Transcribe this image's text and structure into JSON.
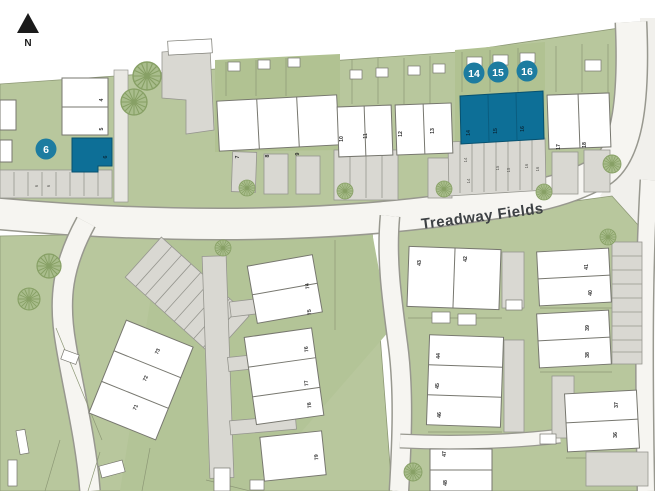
{
  "map": {
    "north_label": "N",
    "street_label": "Treadway Fields",
    "highlighted_plot_badges": [
      "6",
      "14",
      "15",
      "16"
    ],
    "plot_numbers": {
      "top_row": [
        "4",
        "5",
        "6",
        "7",
        "8",
        "9",
        "10",
        "11",
        "12",
        "13",
        "14",
        "15",
        "16",
        "17",
        "18"
      ],
      "terrace_71_73": [
        "71",
        "72",
        "73"
      ],
      "terrace_74_79": [
        "74",
        "75",
        "76",
        "77",
        "78",
        "79"
      ],
      "central_block": [
        "42",
        "43",
        "44",
        "45",
        "46",
        "47",
        "48"
      ],
      "east_block": [
        "36",
        "37",
        "38",
        "39",
        "40",
        "41"
      ],
      "parking_bays": [
        "6",
        "6",
        "14",
        "14",
        "15",
        "15",
        "16",
        "16"
      ]
    },
    "colors": {
      "highlight_teal": "#0d6f97",
      "badge_teal": "#1d7ca0",
      "site_green": "#b8c79d",
      "building_white": "#ffffff",
      "road_fill": "#f6f5f1",
      "parking_grey": "#d9d8d2"
    }
  }
}
